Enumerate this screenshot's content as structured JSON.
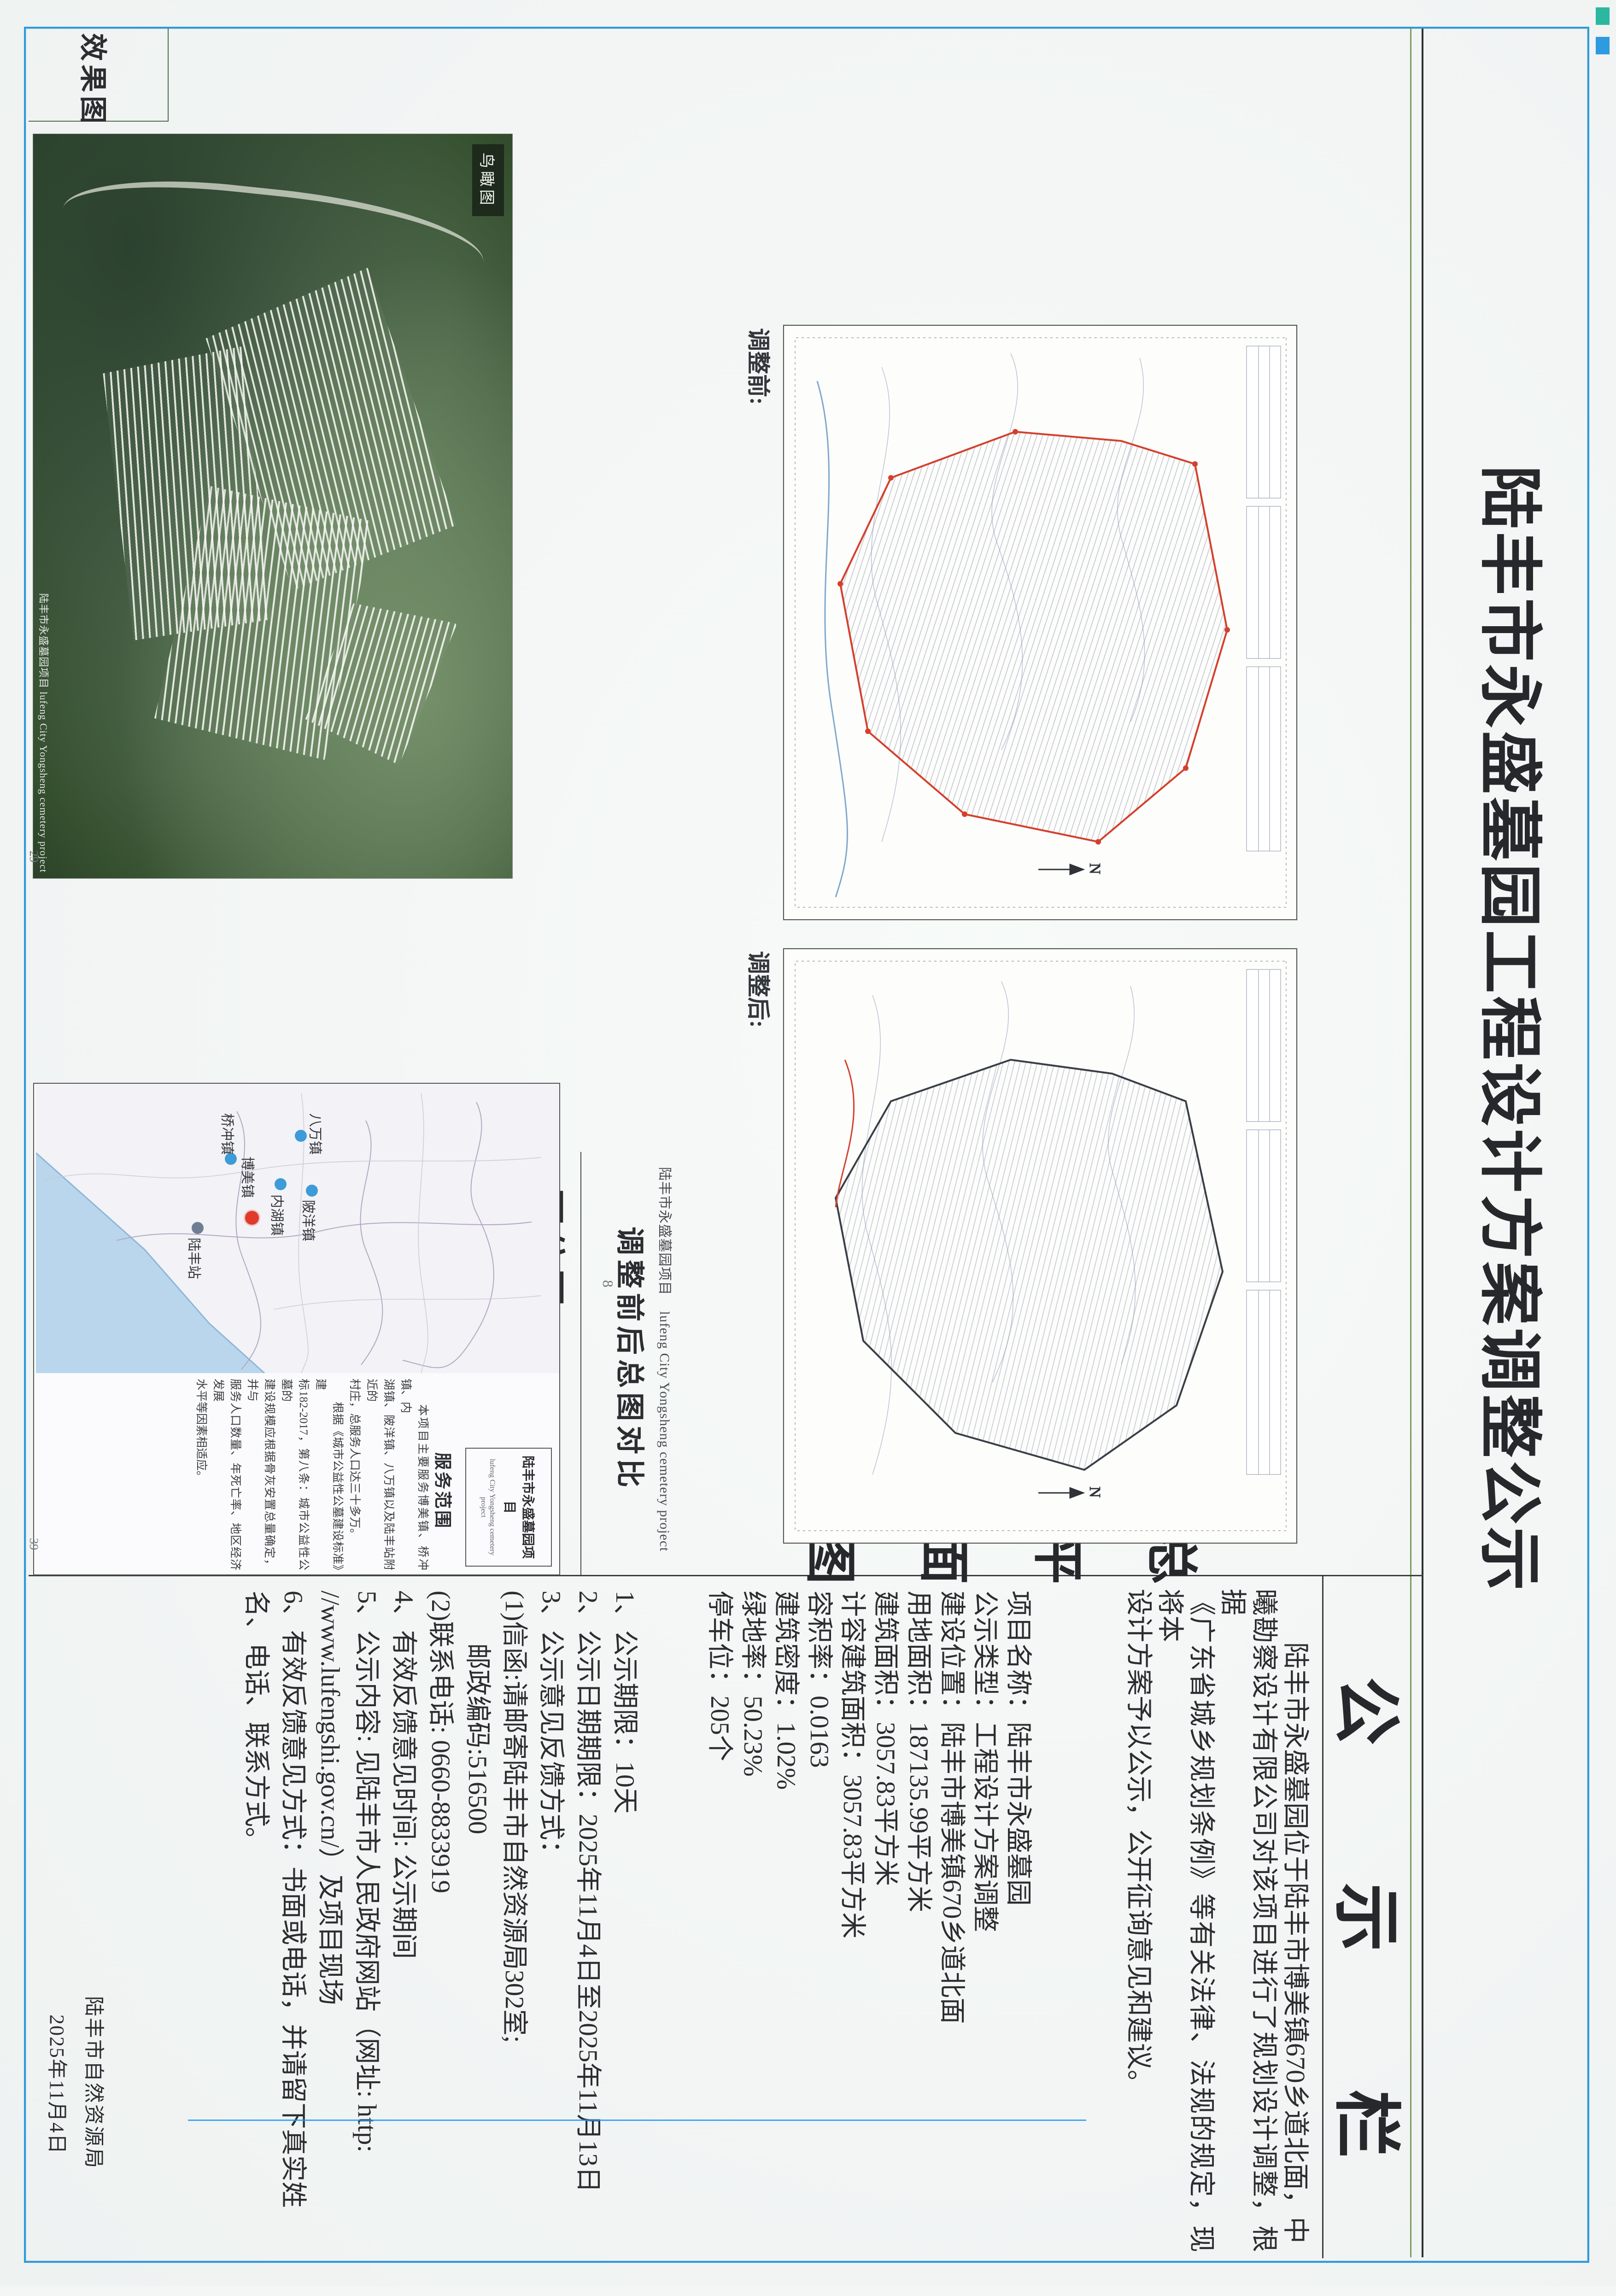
{
  "page": {
    "title": "陆丰市永盛墓园工程设计方案调整公示",
    "issuer": "陆丰市自然资源局",
    "date": "2025年11月4日",
    "border_color": "#2d9bdf"
  },
  "notice": {
    "header": "公示栏",
    "intro_lines": [
      "　　陆丰市永盛墓园位于陆丰市博美镇670乡道北面，中",
      "曦勘察设计有限公司对该项目进行了规划设计调整，根据",
      "《广东省城乡规划条例》等有关法律、法规的规定，现将本",
      "设计方案予以公示，公开征询意见和建议。"
    ],
    "section_label": "总平面图",
    "project_info": [
      "项目名称：陆丰市永盛墓园",
      "公示类型：工程设计方案调整",
      "建设位置：陆丰市博美镇670乡道北面",
      "用地面积：187135.99平方米",
      "建筑面积：3057.83平方米",
      "计容建筑面积：3057.83平方米",
      "容积率：0.0163",
      "建筑密度：1.02%",
      "绿地率：50.23%",
      "停车位：205个"
    ],
    "items": [
      "1、公示期限：10天",
      "2、公示日期期限：2025年11月4日至2025年11月13日",
      "3、公示意见反馈方式：",
      "(1)信函:请邮寄陆丰市自然资源局302室;",
      "　　邮政编码:516500",
      "(2)联系电话: 0660-8833919",
      "4、有效反馈意见时间: 公示期间",
      "5、公示内容: 见陆丰市人民政府网站（网址: http:",
      "//www.lufengshi.gov.cn/）及项目现场",
      "6、有效反馈意见方式：书面或电话，并请留下真实姓",
      "名、电话、联系方式。"
    ]
  },
  "figures": {
    "plan_before_label": "调整前:",
    "plan_after_label": "调整后:",
    "compare_caption_cn": "陆丰市永盛墓园项目",
    "compare_caption_en": "lufeng City Yongsheng cemetery project",
    "compare_caption_main": "调整前后总图对比",
    "plans_page_no": "8",
    "aerial_label": "效果图",
    "aerial_tag": "鸟瞰图",
    "aerial_caption": "陆丰市永盛墓园项目 lufeng City Yongsheng cemetery project",
    "aerial_page_no": "29",
    "map_label": "区位图",
    "map_title_cn": "陆丰市永盛墓园项目",
    "map_title_en": "lufeng City Yongsheng cemetery project",
    "service_title": "服务范围",
    "service_lines": [
      "　　本项目主要服务博美镇、桥冲镇、内",
      "湖镇、陂洋镇、八万镇以及陆丰站附近的",
      "村庄，总服务人口达三十多万。",
      "　　根据《城市公益性公墓建设标准》建",
      "标182-2017，第八条：城市公益性公墓的",
      "建设规模应根据骨灰安置总量确定，并与",
      "服务人口数量、年死亡率、地区经济发展",
      "水平等因素相适应。"
    ],
    "map_page_no": "39",
    "towns": [
      {
        "name": "八万镇"
      },
      {
        "name": "陂洋镇"
      },
      {
        "name": "内湖镇"
      },
      {
        "name": "博美镇"
      },
      {
        "name": "桥冲镇"
      },
      {
        "name": "陆丰站"
      }
    ]
  }
}
